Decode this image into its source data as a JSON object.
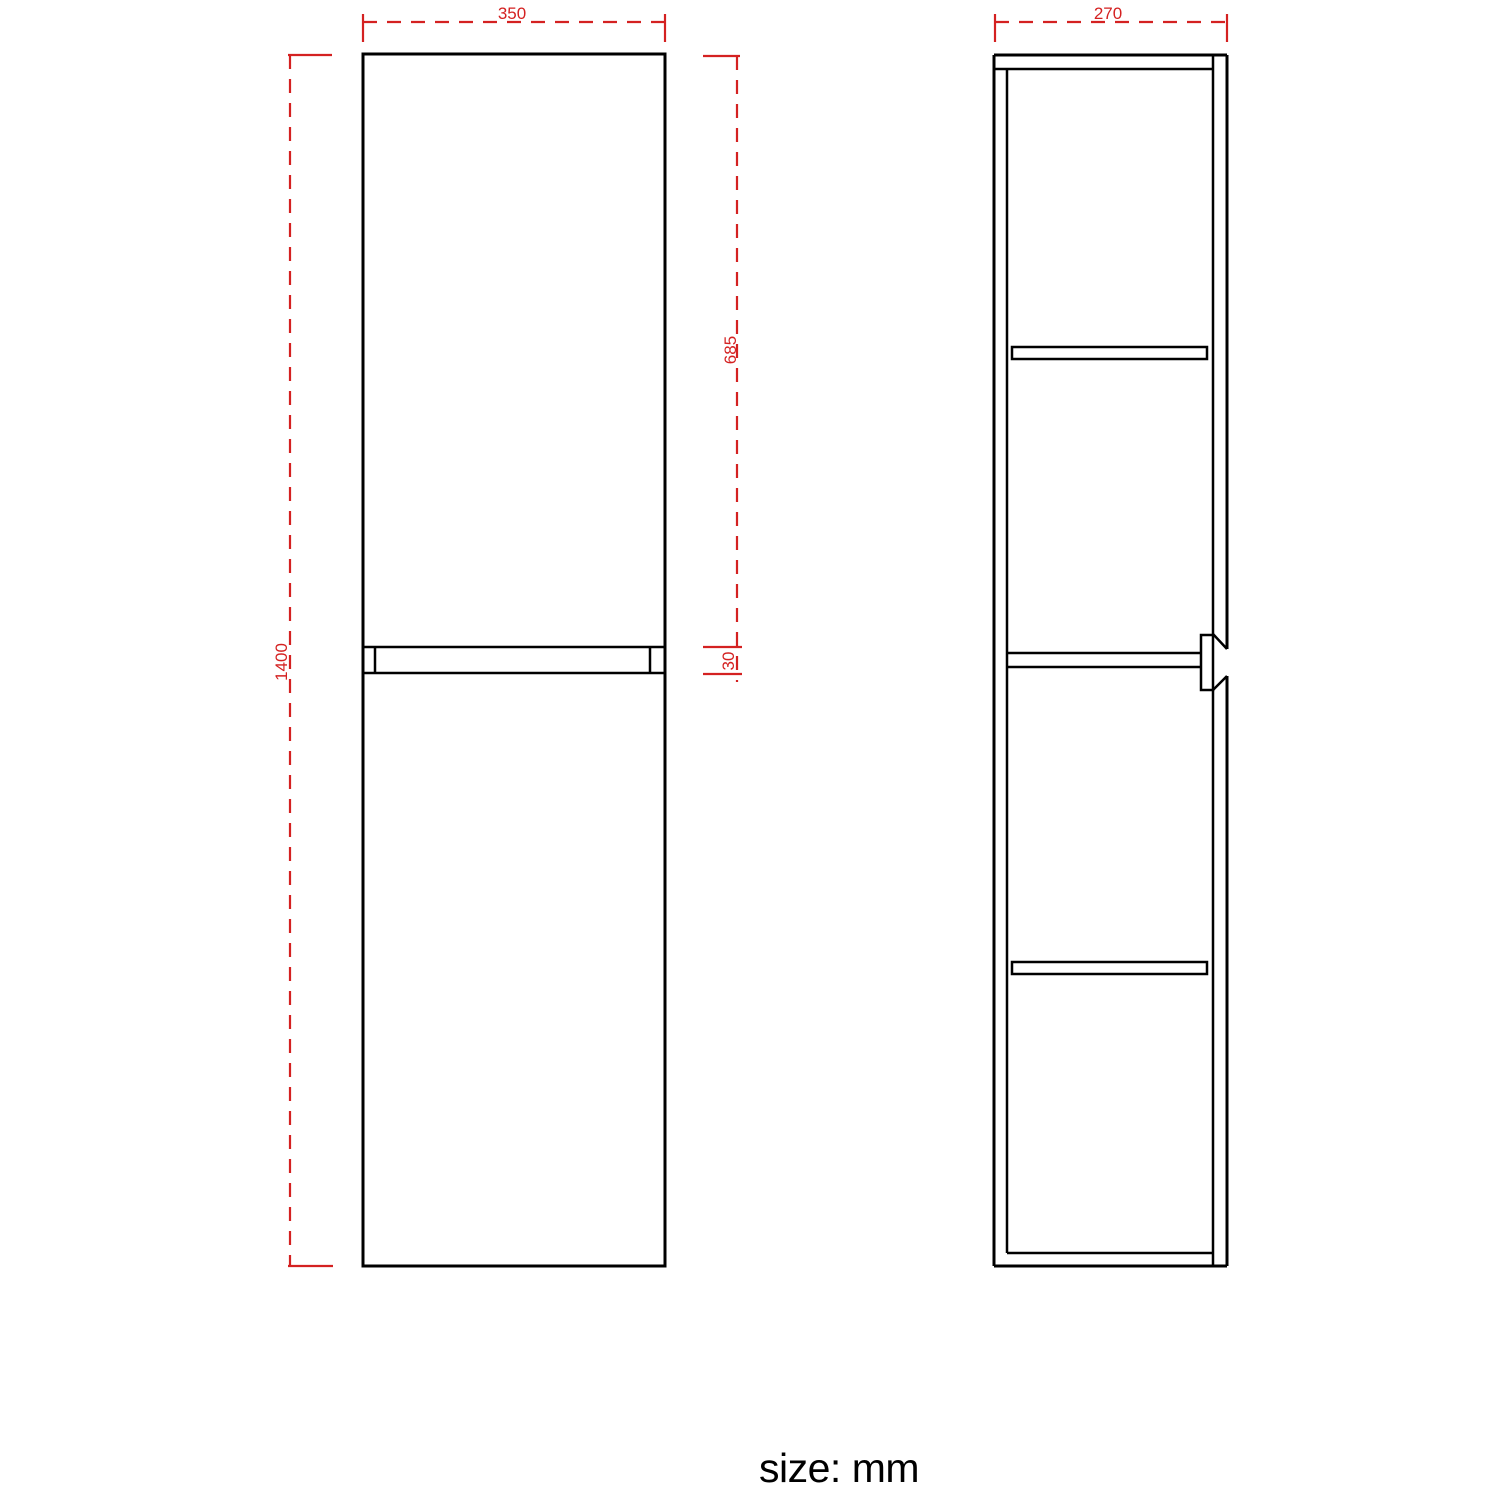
{
  "drawing": {
    "front_view": {
      "width_mm": "350",
      "height_mm": "1400",
      "upper_door_height_mm": "685",
      "door_gap_mm": "30"
    },
    "side_view": {
      "depth_mm": "270"
    },
    "units_note": "size: mm"
  },
  "colors": {
    "line": "#000000",
    "dimension": "#d42121",
    "background": "#ffffff"
  }
}
